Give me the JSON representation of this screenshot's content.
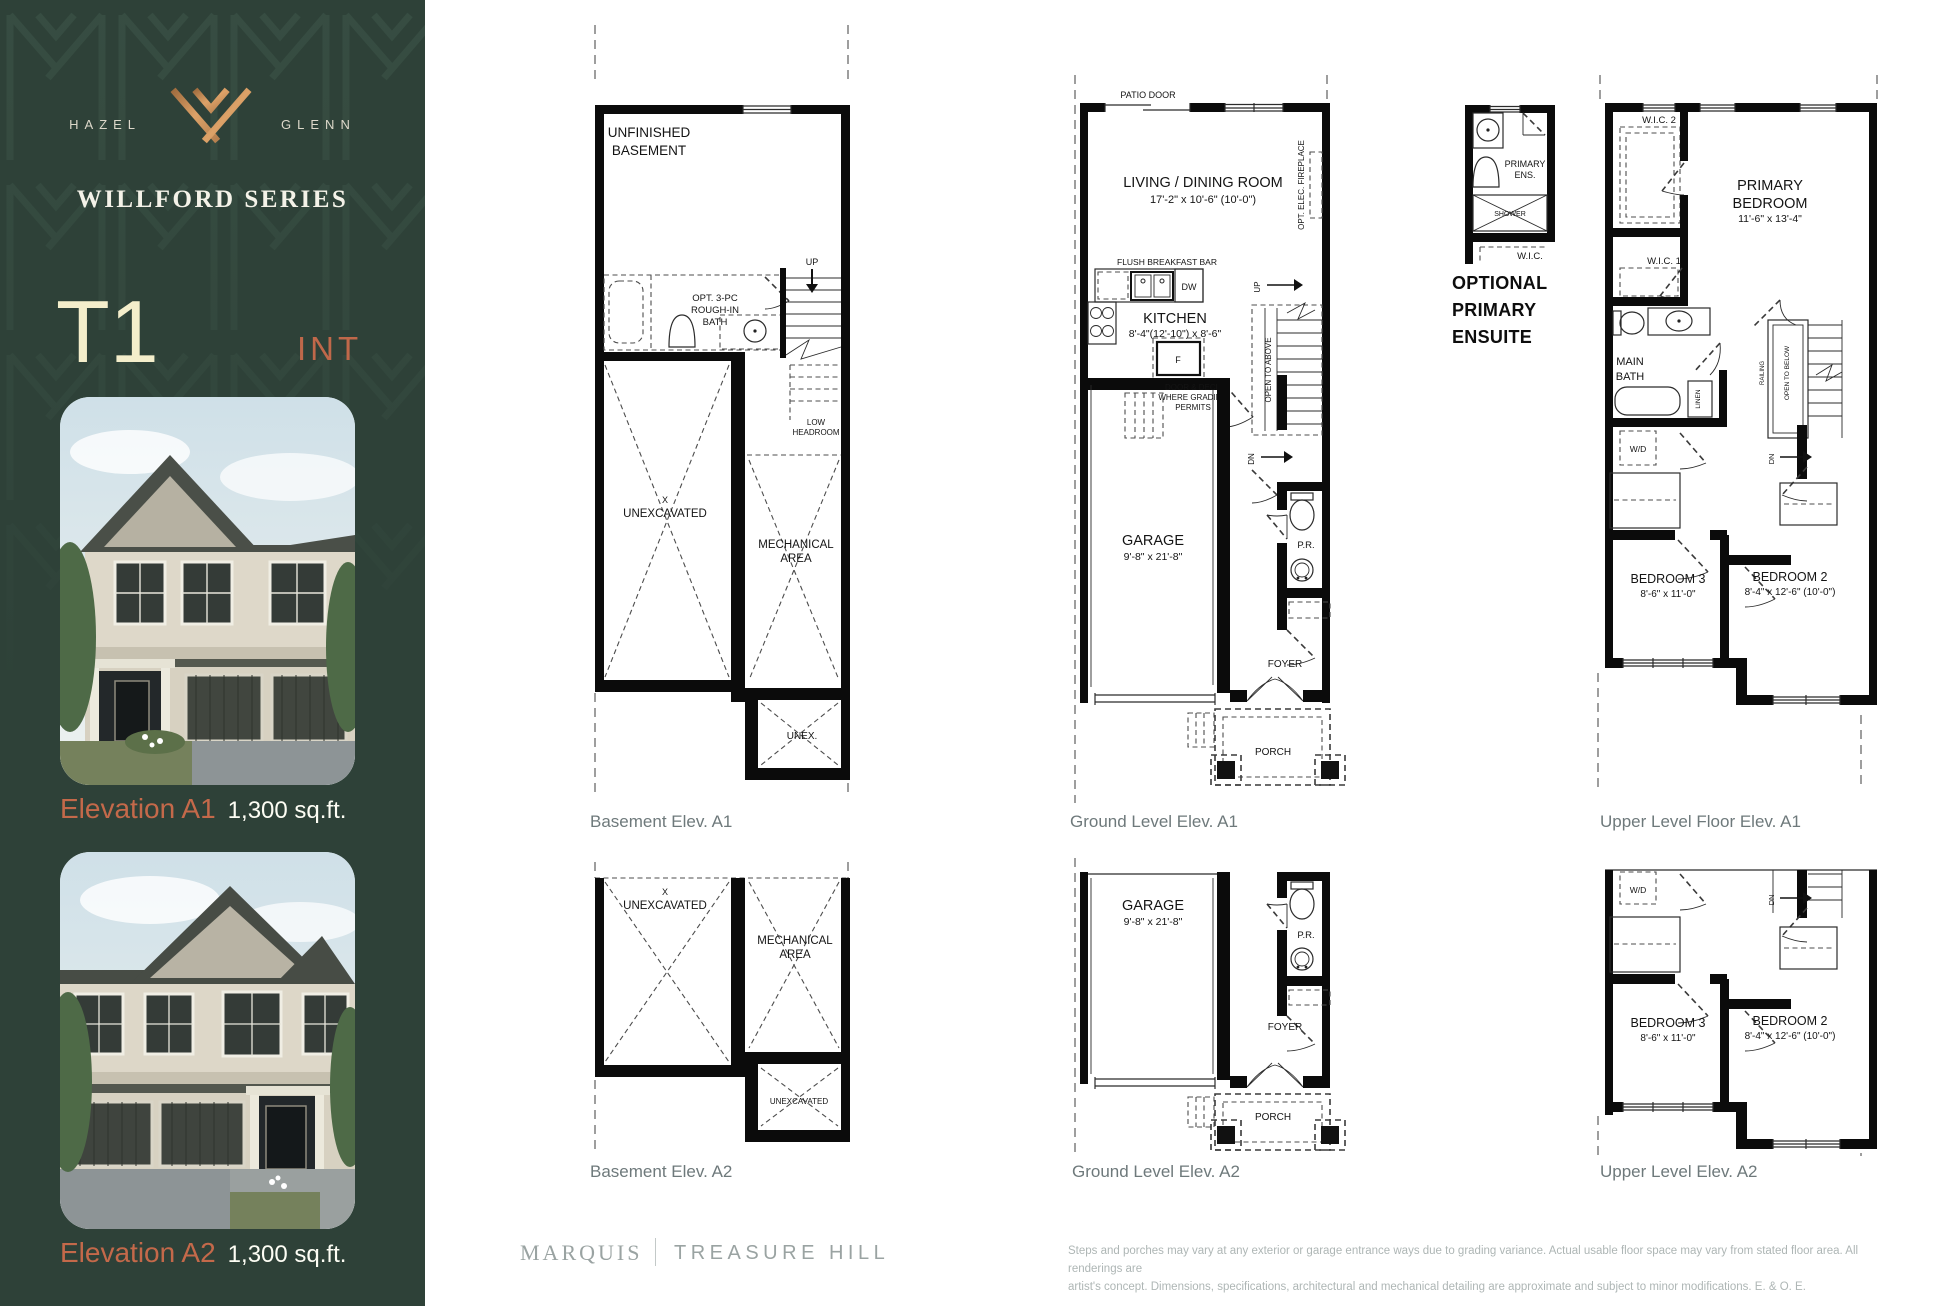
{
  "sidebar": {
    "brand_left": "HAZEL",
    "brand_right": "GLENN",
    "series": "WILLFORD SERIES",
    "model": "T1",
    "model_type": "INT",
    "elevation_a1_label": "Elevation A1",
    "elevation_a1_sqft": "1,300 sq.ft.",
    "elevation_a2_label": "Elevation A2",
    "elevation_a2_sqft": "1,300 sq.ft."
  },
  "colors": {
    "sidebar_green": "#2e4138",
    "copper": "#c9885a",
    "accent_orange": "#c4694a",
    "cream": "#f4eecb"
  },
  "basement_a1": {
    "caption": "Basement Elev. A1",
    "room1": "UNFINISHED",
    "room2": "BASEMENT",
    "bath1": "OPT. 3-PC",
    "bath2": "ROUGH-IN",
    "bath3": "BATH",
    "up": "UP",
    "low1": "LOW",
    "low2": "HEADROOM",
    "x": "X",
    "unexcavated": "UNEXCAVATED",
    "mech1": "MECHANICAL",
    "mech2": "AREA",
    "unex": "UNEX."
  },
  "ground_a1": {
    "caption": "Ground Level Elev. A1",
    "patio_door": "PATIO DOOR",
    "living": "LIVING / DINING ROOM",
    "living_dims": "17'-2\" x 10'-6\" (10'-0\")",
    "fireplace": "OPT. ELEC. FIREPLACE",
    "breakfast_bar": "FLUSH BREAKFAST BAR",
    "dw": "DW",
    "kitchen": "KITCHEN",
    "kitchen_dims": "8'-4\"(12'-10\") x 8'-6\"",
    "fridge": "F",
    "up": "UP",
    "deck1": "DOOR & DECK",
    "deck2": "WHERE GRADING",
    "deck3": "PERMITS",
    "open_above": "OPEN TO ABOVE",
    "dn": "DN",
    "garage": "GARAGE",
    "garage_dims": "9'-8\" x 21'-8\"",
    "pr": "P.R.",
    "foyer": "FOYER",
    "porch": "PORCH"
  },
  "ensuite": {
    "title1": "OPTIONAL",
    "title2": "PRIMARY",
    "title3": "ENSUITE",
    "label1": "PRIMARY",
    "label2": "ENS.",
    "shower": "SHOWER",
    "wic": "W.I.C."
  },
  "upper_a1": {
    "caption": "Upper Level Floor Elev. A1",
    "wic2": "W.I.C. 2",
    "primary1": "PRIMARY",
    "primary2": "BEDROOM",
    "primary_dims": "11'-6\" x 13'-4\"",
    "wic1": "W.I.C. 1",
    "bath1": "MAIN",
    "bath2": "BATH",
    "linen": "LINEN",
    "wd": "W/D",
    "railing": "RAILING",
    "open_below": "OPEN TO BELOW",
    "dn": "DN",
    "bed3": "BEDROOM 3",
    "bed3_dims": "8'-6\" x 11'-0\"",
    "bed2": "BEDROOM 2",
    "bed2_dims": "8'-4\" x 12'-6\" (10'-0\")"
  },
  "basement_a2": {
    "caption": "Basement Elev. A2",
    "x": "X",
    "unexcavated": "UNEXCAVATED",
    "mech1": "MECHANICAL",
    "mech2": "AREA",
    "unex2": "UNEXCAVATED"
  },
  "ground_a2": {
    "caption": "Ground Level Elev. A2",
    "garage": "GARAGE",
    "garage_dims": "9'-8\" x 21'-8\"",
    "pr": "P.R.",
    "foyer": "FOYER",
    "porch": "PORCH"
  },
  "upper_a2": {
    "caption": "Upper Level Elev. A2",
    "wd": "W/D",
    "dn": "DN",
    "bed3": "BEDROOM 3",
    "bed3_dims": "8'-6\" x 11'-0\"",
    "bed2": "BEDROOM 2",
    "bed2_dims": "8'-4\" x 12'-6\" (10'-0\")"
  },
  "footer": {
    "brand1": "MARQUIS",
    "brand2": "TREASURE HILL",
    "disclaimer1": "Steps and porches may vary at any exterior or garage entrance ways due to grading variance. Actual usable floor space may vary from stated floor area. All renderings are",
    "disclaimer2": "artist's concept. Dimensions, specifications, architectural and mechanical detailing are approximate and subject to minor modifications. E. & O. E."
  }
}
